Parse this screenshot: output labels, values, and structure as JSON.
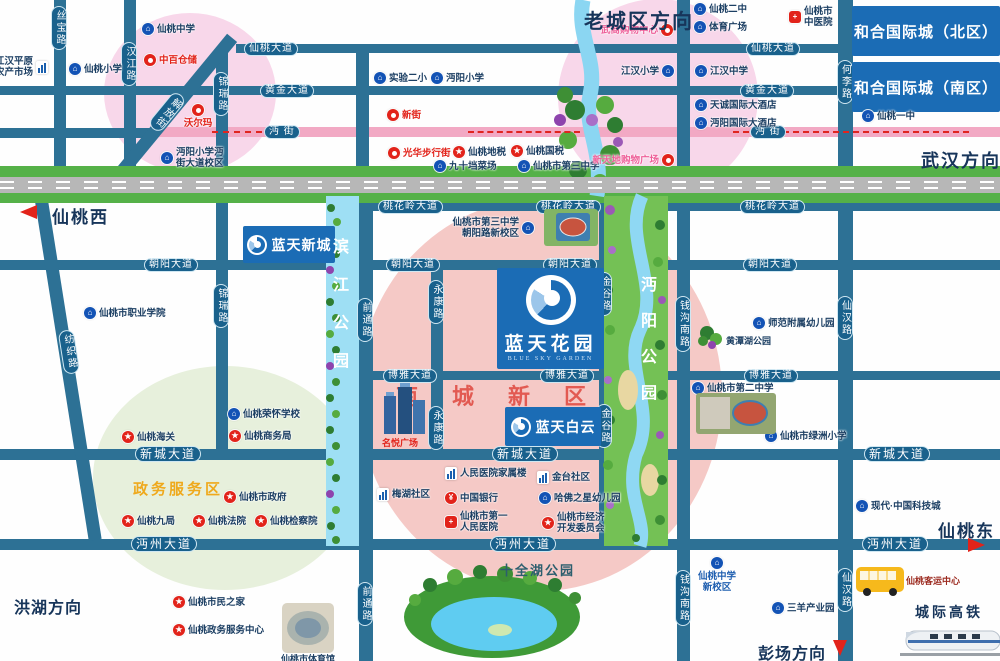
{
  "title": "蓝天花园区位图",
  "areas": [
    {
      "name": "old-town-pink-circle-west",
      "cx": 190,
      "cy": 93,
      "rx": 86,
      "ry": 80,
      "color": "#f8d7ea"
    },
    {
      "name": "old-town-pink-circle-east",
      "cx": 658,
      "cy": 97,
      "rx": 100,
      "ry": 98,
      "color": "#f8d7ea"
    },
    {
      "name": "nancheng-new-district-area",
      "cx": 540,
      "cy": 395,
      "rx": 182,
      "ry": 196,
      "color": "#f5c9c6"
    },
    {
      "name": "gov-service-area-circle",
      "cx": 225,
      "cy": 478,
      "rx": 132,
      "ry": 112,
      "color": "#e7f0dc"
    }
  ],
  "roads_h": [
    {
      "name": "xiantao-avenue",
      "label": "仙桃大道",
      "y": 44,
      "h": 9,
      "x1": 236,
      "x2": 1000,
      "labels": [
        244,
        746
      ]
    },
    {
      "name": "huangjin-avenue",
      "label": "黄金大道",
      "y": 86,
      "h": 9,
      "x1": 0,
      "x2": 1000,
      "labels": [
        260,
        740
      ]
    },
    {
      "name": "mianjie-west-stub",
      "label": "",
      "y": 128,
      "h": 10,
      "x1": 0,
      "x2": 158,
      "labels": []
    },
    {
      "name": "mianjie-street",
      "label": "沔  街",
      "y": 127,
      "h": 10,
      "x1": 150,
      "x2": 1000,
      "pink": true,
      "labels": [
        264,
        750
      ]
    },
    {
      "name": "taohualing-avenue",
      "label": "桃花岭大道",
      "y": 202,
      "h": 9,
      "x1": 356,
      "x2": 1000,
      "labels": [
        378,
        536,
        740
      ]
    },
    {
      "name": "chaoyang-avenue",
      "label": "朝阳大道",
      "y": 260,
      "h": 10,
      "x1": 0,
      "x2": 1000,
      "labels": [
        144,
        386,
        543,
        743
      ]
    },
    {
      "name": "boya-avenue",
      "label": "博雅大道",
      "y": 371,
      "h": 9,
      "x1": 357,
      "x2": 1000,
      "labels": [
        383,
        540,
        744
      ]
    },
    {
      "name": "xincheng-avenue",
      "label": "新城大道",
      "y": 449,
      "h": 11,
      "x1": 0,
      "x2": 1000,
      "big": true,
      "labels": [
        135,
        492,
        864
      ]
    },
    {
      "name": "mianzhou-avenue",
      "label": "沔州大道",
      "y": 539,
      "h": 11,
      "x1": 0,
      "x2": 1000,
      "big": true,
      "labels": [
        131,
        490,
        862
      ]
    }
  ],
  "roads_v": [
    {
      "name": "sibao-road",
      "label": "丝宝路",
      "x": 54,
      "w": 12,
      "y1": 0,
      "y2": 176,
      "labels": [
        6
      ]
    },
    {
      "name": "hanjiang-road",
      "label": "汉江路",
      "x": 124,
      "w": 12,
      "y1": 0,
      "y2": 176,
      "labels": [
        42
      ]
    },
    {
      "name": "jinrui-road",
      "label": "锦瑞路",
      "x": 216,
      "w": 12,
      "y1": 48,
      "y2": 455,
      "labels": [
        72,
        284
      ]
    },
    {
      "name": "north-stub-road",
      "label": "",
      "x": 356,
      "w": 13,
      "y1": 44,
      "y2": 178,
      "labels": []
    },
    {
      "name": "qiantong-road",
      "label": "前通路",
      "x": 359,
      "w": 14,
      "y1": 196,
      "y2": 661,
      "labels": [
        298,
        582
      ]
    },
    {
      "name": "yongkang-road",
      "label": "永康路",
      "x": 431,
      "w": 12,
      "y1": 260,
      "y2": 460,
      "labels": [
        280,
        406
      ]
    },
    {
      "name": "jingu-road",
      "label": "金谷路",
      "x": 599,
      "w": 12,
      "y1": 202,
      "y2": 550,
      "labels": [
        272,
        404
      ]
    },
    {
      "name": "qiangou-south-road",
      "label": "钱沟南路",
      "x": 677,
      "w": 13,
      "y1": 0,
      "y2": 661,
      "labels": [
        296,
        570
      ]
    },
    {
      "name": "heli-road",
      "label": "何李路",
      "x": 838,
      "w": 15,
      "y1": 0,
      "y2": 177,
      "labels": [
        60
      ]
    },
    {
      "name": "xianhan-road",
      "label": "仙汉路",
      "x": 838,
      "w": 15,
      "y1": 177,
      "y2": 661,
      "labels": [
        296,
        568
      ]
    }
  ],
  "diagonals": [
    {
      "name": "jiefang-street",
      "label": "解放街",
      "cx": 168,
      "cy": 115,
      "len": 200,
      "w": 13,
      "angle": 39.5,
      "lx": 168,
      "ly": 90
    },
    {
      "name": "fangzhi-road",
      "label": "纺织路",
      "cx": 67,
      "cy": 365,
      "len": 354,
      "w": 13,
      "angle": -9,
      "lx": 70,
      "ly": 330
    }
  ],
  "banners": [
    {
      "name": "hehe-international-north",
      "label": "和合国际城（北区）",
      "x": 852,
      "y": 6,
      "w": 148,
      "h": 50,
      "fs": 15
    },
    {
      "name": "hehe-international-south",
      "label": "和合国际城（南区）",
      "x": 852,
      "y": 62,
      "w": 148,
      "h": 50,
      "fs": 15
    },
    {
      "name": "lantian-xincheng",
      "label": "蓝天新城",
      "x": 243,
      "y": 226,
      "w": 92,
      "h": 37,
      "fs": 14,
      "logo": true
    },
    {
      "name": "lantian-baiyun",
      "label": "蓝天白云",
      "x": 505,
      "y": 407,
      "w": 96,
      "h": 39,
      "fs": 14,
      "logo": true
    }
  ],
  "project": {
    "name": "lantian-huayuan",
    "label": "蓝天花园",
    "sub": "BLUE SKY GARDEN",
    "x": 497,
    "y": 268,
    "w": 107,
    "h": 101
  },
  "pois": [
    {
      "name": "jianghan-plain-farm-market",
      "t": "building",
      "x": 42,
      "y": 67,
      "side": "l",
      "c": "dark",
      "lines": [
        "江汉平原",
        "农产市场"
      ]
    },
    {
      "name": "xiantao-primary-school",
      "t": "school",
      "x": 75,
      "y": 69,
      "side": "r",
      "c": "dark",
      "lines": [
        "仙桃小学"
      ]
    },
    {
      "name": "xiantao-middle-school",
      "t": "school",
      "x": 148,
      "y": 29,
      "side": "r",
      "c": "dark",
      "lines": [
        "仙桃中学"
      ]
    },
    {
      "name": "zhongbai-warehouse",
      "t": "shop",
      "x": 150,
      "y": 60,
      "side": "r",
      "c": "red",
      "lines": [
        "中百仓储"
      ]
    },
    {
      "name": "walmart",
      "t": "shop",
      "x": 198,
      "y": 110,
      "side": "b",
      "c": "red",
      "lines": [
        "沃尔玛"
      ]
    },
    {
      "name": "mianyang-primary-mianjie-campus",
      "t": "school",
      "x": 167,
      "y": 158,
      "side": "r",
      "c": "dark",
      "lines": [
        "沔阳小学沔",
        "街大道校区"
      ]
    },
    {
      "name": "shiyan-no2-primary",
      "t": "school",
      "x": 380,
      "y": 78,
      "side": "r",
      "c": "dark",
      "lines": [
        "实验二小"
      ]
    },
    {
      "name": "mianyang-primary",
      "t": "school",
      "x": 437,
      "y": 78,
      "side": "r",
      "c": "dark",
      "lines": [
        "沔阳小学"
      ]
    },
    {
      "name": "xinjie",
      "t": "shop",
      "x": 393,
      "y": 115,
      "side": "r",
      "c": "red",
      "lines": [
        "新街"
      ]
    },
    {
      "name": "guanghua-walking-street",
      "t": "shop",
      "x": 394,
      "y": 153,
      "side": "r",
      "c": "red",
      "lines": [
        "光华步行街"
      ]
    },
    {
      "name": "xiantao-local-tax",
      "t": "star",
      "x": 459,
      "y": 152,
      "side": "r",
      "c": "dark",
      "lines": [
        "仙桃地税"
      ]
    },
    {
      "name": "xiantao-national-tax",
      "t": "star",
      "x": 517,
      "y": 151,
      "side": "r",
      "c": "dark",
      "lines": [
        "仙桃国税"
      ]
    },
    {
      "name": "jiushidang-market",
      "t": "school",
      "x": 440,
      "y": 166,
      "side": "r",
      "c": "dark",
      "lines": [
        "九十垱菜场"
      ]
    },
    {
      "name": "xiantao-no3-middle-school",
      "t": "school",
      "x": 524,
      "y": 166,
      "side": "r",
      "c": "dark",
      "lines": [
        "仙桃市第三中学"
      ]
    },
    {
      "name": "wushang-shopping-center",
      "t": "shop",
      "x": 667,
      "y": 30,
      "side": "l",
      "c": "pink",
      "lines": [
        "武商购物中心"
      ]
    },
    {
      "name": "xiantao-no2-high-school",
      "t": "school",
      "x": 700,
      "y": 9,
      "side": "r",
      "c": "dark",
      "lines": [
        "仙桃二中"
      ]
    },
    {
      "name": "sports-plaza",
      "t": "school",
      "x": 700,
      "y": 27,
      "side": "r",
      "c": "dark",
      "lines": [
        "体育广场"
      ]
    },
    {
      "name": "jianghan-primary-school",
      "t": "school",
      "x": 668,
      "y": 71,
      "side": "l",
      "c": "dark",
      "lines": [
        "江汉小学"
      ]
    },
    {
      "name": "jianghan-middle-school",
      "t": "school",
      "x": 701,
      "y": 71,
      "side": "r",
      "c": "dark",
      "lines": [
        "江汉中学"
      ]
    },
    {
      "name": "tiancheng-intl-hotel",
      "t": "school",
      "x": 701,
      "y": 105,
      "side": "r",
      "c": "dark",
      "lines": [
        "天诚国际大酒店"
      ]
    },
    {
      "name": "mianyang-intl-hotel",
      "t": "school",
      "x": 701,
      "y": 123,
      "side": "r",
      "c": "dark",
      "lines": [
        "沔阳国际大酒店"
      ]
    },
    {
      "name": "xintiandi-shopping-plaza",
      "t": "shop",
      "x": 668,
      "y": 160,
      "side": "l",
      "c": "pink",
      "lines": [
        "新天地购物广场"
      ]
    },
    {
      "name": "xiantao-tcm-hospital",
      "t": "hospital",
      "x": 795,
      "y": 17,
      "side": "r",
      "c": "dark",
      "lines": [
        "仙桃市",
        "中医院"
      ]
    },
    {
      "name": "xiantao-no1-high-school",
      "t": "school",
      "x": 868,
      "y": 116,
      "side": "r",
      "c": "dark",
      "lines": [
        "仙桃一中"
      ]
    },
    {
      "name": "xiantao-vocational-college",
      "t": "school",
      "x": 90,
      "y": 313,
      "side": "r",
      "c": "dark",
      "lines": [
        "仙桃市职业学院"
      ]
    },
    {
      "name": "xiantao-customs",
      "t": "star",
      "x": 128,
      "y": 437,
      "side": "r",
      "c": "dark",
      "lines": [
        "仙桃海关"
      ]
    },
    {
      "name": "xiantao-ronghuai-school",
      "t": "school",
      "x": 234,
      "y": 414,
      "side": "r",
      "c": "dark",
      "lines": [
        "仙桃荣怀学校"
      ]
    },
    {
      "name": "xiantao-commerce-bureau",
      "t": "star",
      "x": 235,
      "y": 436,
      "side": "r",
      "c": "dark",
      "lines": [
        "仙桃商务局"
      ]
    },
    {
      "name": "xiantao-city-government",
      "t": "star",
      "x": 230,
      "y": 497,
      "side": "r",
      "c": "dark",
      "lines": [
        "仙桃市政府"
      ]
    },
    {
      "name": "xiantao-jiuju",
      "t": "star",
      "x": 128,
      "y": 521,
      "side": "r",
      "c": "dark",
      "lines": [
        "仙桃九局"
      ]
    },
    {
      "name": "xiantao-court",
      "t": "star",
      "x": 199,
      "y": 521,
      "side": "r",
      "c": "dark",
      "lines": [
        "仙桃法院"
      ]
    },
    {
      "name": "xiantao-procuratorate",
      "t": "star",
      "x": 261,
      "y": 521,
      "side": "r",
      "c": "dark",
      "lines": [
        "仙桃检察院"
      ]
    },
    {
      "name": "xiantao-citizens-home",
      "t": "star",
      "x": 179,
      "y": 602,
      "side": "r",
      "c": "dark",
      "lines": [
        "仙桃市民之家"
      ]
    },
    {
      "name": "xiantao-gov-service-center",
      "t": "star",
      "x": 179,
      "y": 630,
      "side": "r",
      "c": "dark",
      "lines": [
        "仙桃政务服务中心"
      ]
    },
    {
      "name": "no3-middle-school-chaoyang-campus",
      "t": "school",
      "x": 528,
      "y": 228,
      "side": "l",
      "c": "dark",
      "lines": [
        "仙桃市第三中学",
        "朝阳路新校区"
      ]
    },
    {
      "name": "meihu-community",
      "t": "building",
      "x": 383,
      "y": 494,
      "side": "r",
      "c": "dark",
      "lines": [
        "梅湖社区"
      ]
    },
    {
      "name": "peoples-hospital-staff-building",
      "t": "building",
      "x": 451,
      "y": 473,
      "side": "r",
      "c": "dark",
      "lines": [
        "人民医院家属楼"
      ]
    },
    {
      "name": "bank-of-china",
      "t": "bank",
      "x": 451,
      "y": 498,
      "side": "r",
      "c": "dark",
      "lines": [
        "中国银行"
      ]
    },
    {
      "name": "xiantao-no1-peoples-hospital",
      "t": "hospital",
      "x": 451,
      "y": 522,
      "side": "r",
      "c": "dark",
      "lines": [
        "仙桃市第一",
        "人民医院"
      ]
    },
    {
      "name": "jintai-community",
      "t": "building",
      "x": 543,
      "y": 477,
      "side": "r",
      "c": "dark",
      "lines": [
        "金台社区"
      ]
    },
    {
      "name": "harvard-star-kindergarten",
      "t": "school",
      "x": 545,
      "y": 498,
      "side": "r",
      "c": "dark",
      "lines": [
        "哈佛之星幼儿园"
      ]
    },
    {
      "name": "economic-development-committee",
      "t": "star",
      "x": 548,
      "y": 523,
      "side": "r",
      "c": "dark",
      "lines": [
        "仙桃市经济",
        "开发委员会"
      ]
    },
    {
      "name": "normal-school-kindergarten",
      "t": "school",
      "x": 759,
      "y": 323,
      "side": "r",
      "c": "dark",
      "lines": [
        "师范附属幼儿园"
      ]
    },
    {
      "name": "xiantao-no2-middle-school",
      "t": "school",
      "x": 698,
      "y": 388,
      "side": "r",
      "c": "dark",
      "lines": [
        "仙桃市第二中学"
      ]
    },
    {
      "name": "xiantao-lvzhou-primary",
      "t": "school",
      "x": 771,
      "y": 436,
      "side": "r",
      "c": "dark",
      "lines": [
        "仙桃市绿洲小学"
      ]
    },
    {
      "name": "modern-china-tech-city",
      "t": "school",
      "x": 862,
      "y": 506,
      "side": "r",
      "c": "dark",
      "lines": [
        "现代·中国科技城"
      ]
    },
    {
      "name": "xiantao-high-school-new-campus",
      "t": "school",
      "x": 717,
      "y": 563,
      "side": "b",
      "c": "blue",
      "lines": [
        "仙桃中学",
        "新校区"
      ]
    },
    {
      "name": "sanyang-industrial-park",
      "t": "school",
      "x": 778,
      "y": 608,
      "side": "r",
      "c": "dark",
      "lines": [
        "三羊产业园"
      ]
    }
  ],
  "texts": [
    {
      "name": "direction-old-town",
      "text": "老城区方向",
      "x": 584,
      "y": 5,
      "size": 20,
      "color": "#17355a",
      "serif": true,
      "ls": 2
    },
    {
      "name": "direction-wuhan",
      "text": "武汉方向",
      "x": 921,
      "y": 147,
      "size": 18,
      "color": "#17355a",
      "serif": true,
      "ls": 2
    },
    {
      "name": "exit-xiantao-west",
      "text": "仙桃西",
      "x": 52,
      "y": 203,
      "size": 17,
      "color": "#17355a",
      "serif": true,
      "ls": 2
    },
    {
      "name": "exit-xiantao-east",
      "text": "仙桃东",
      "x": 938,
      "y": 517,
      "size": 17,
      "color": "#17355a",
      "serif": true,
      "ls": 2
    },
    {
      "name": "direction-honghu",
      "text": "洪湖方向",
      "x": 14,
      "y": 594,
      "size": 16,
      "color": "#17355a",
      "serif": true,
      "ls": 1
    },
    {
      "name": "direction-pengchang",
      "text": "彭场方向",
      "x": 758,
      "y": 640,
      "size": 16,
      "color": "#17355a",
      "serif": true,
      "ls": 1
    },
    {
      "name": "label-nancheng-new-district",
      "text": "南城新区",
      "x": 396,
      "y": 379,
      "size": 22,
      "color": "#e25a52",
      "serif": true,
      "ls": 34
    },
    {
      "name": "label-gov-service-area",
      "text": "政务服务区",
      "x": 133,
      "y": 478,
      "size": 15,
      "color": "#efa91c",
      "serif": true,
      "ls": 3
    },
    {
      "name": "label-shiquan-lake-park",
      "text": "十全湖公园",
      "x": 500,
      "y": 560,
      "size": 13,
      "color": "#2c5e6e",
      "serif": true,
      "ls": 2
    },
    {
      "name": "label-binjiang-park",
      "text": "滨江公园",
      "x": 326,
      "y": 238,
      "size": 16,
      "color": "#ffffff",
      "serif": true,
      "vertical": true,
      "ls": 22
    },
    {
      "name": "label-mianyang-park",
      "text": "沔阳公园",
      "x": 634,
      "y": 276,
      "size": 16,
      "color": "#ffffff",
      "serif": true,
      "vertical": true,
      "ls": 20
    },
    {
      "name": "label-huangtan-lake-park",
      "text": "黄潭湖公园",
      "x": 726,
      "y": 334,
      "size": 9,
      "color": "#1c3f63"
    },
    {
      "name": "label-mingyue-plaza",
      "text": "名悦广场",
      "x": 382,
      "y": 436,
      "size": 9,
      "color": "#e2231a"
    },
    {
      "name": "label-passenger-center",
      "text": "仙桃客运中心",
      "x": 906,
      "y": 574,
      "size": 9,
      "color": "#9c2b20"
    },
    {
      "name": "label-intercity-hsr",
      "text": "城际高铁",
      "x": 915,
      "y": 602,
      "size": 14,
      "color": "#17355a",
      "serif": true,
      "ls": 3
    },
    {
      "name": "label-stadium",
      "text": "仙桃市体育馆",
      "x": 281,
      "y": 652,
      "size": 9,
      "color": "#1c3f63"
    }
  ],
  "arrows": [
    {
      "name": "west-arrow",
      "dir": "left",
      "x": 20,
      "y": 205
    },
    {
      "name": "east-arrow",
      "dir": "right",
      "x": 968,
      "y": 538
    },
    {
      "name": "pengchang-arrow",
      "dir": "down",
      "x": 833,
      "y": 640
    }
  ],
  "dashes": [
    {
      "x": 212,
      "y": 131,
      "w": 50
    },
    {
      "x": 468,
      "y": 131,
      "w": 112
    },
    {
      "x": 733,
      "y": 131,
      "w": 236
    }
  ]
}
